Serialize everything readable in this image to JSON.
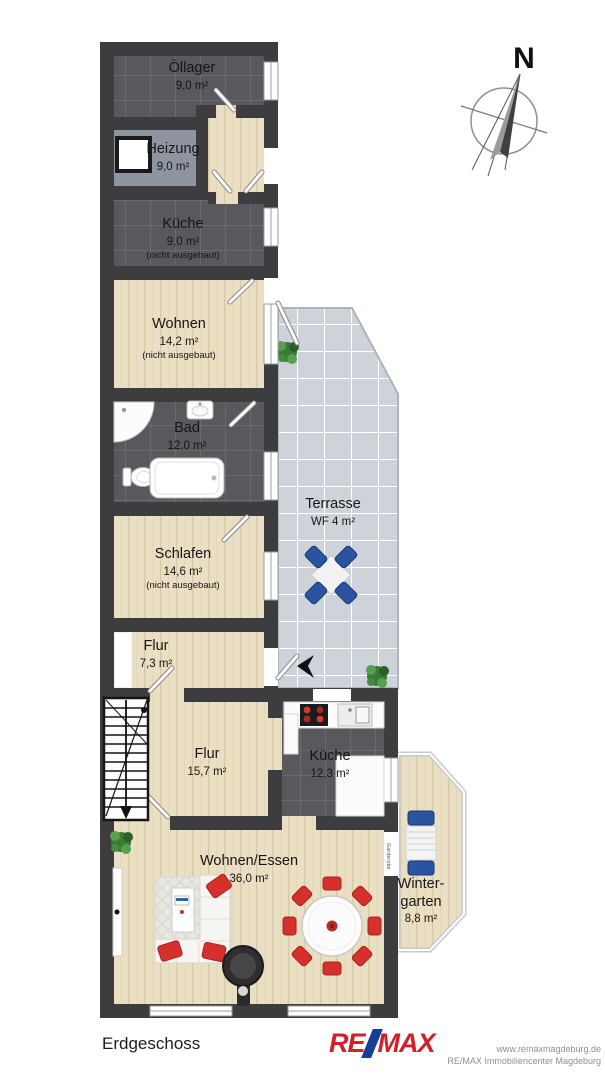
{
  "compass": {
    "north_label": "N"
  },
  "rooms": {
    "oellager": {
      "name": "Öllager",
      "area": "9,0 m²"
    },
    "heizung": {
      "name": "Heizung",
      "area": "9,0 m²"
    },
    "kueche_dg": {
      "name": "Küche",
      "area": "9,0 m²",
      "note": "(nicht ausgebaut)"
    },
    "wohnen": {
      "name": "Wohnen",
      "area": "14,2 m²",
      "note": "(nicht ausgebaut)"
    },
    "bad": {
      "name": "Bad",
      "area": "12,0 m²"
    },
    "schlafen": {
      "name": "Schlafen",
      "area": "14,6 m²",
      "note": "(nicht ausgebaut)"
    },
    "terrasse": {
      "name": "Terrasse",
      "area": "WF 4 m²"
    },
    "flur_klein": {
      "name": "Flur",
      "area": "7,3 m²"
    },
    "flur_gross": {
      "name": "Flur",
      "area": "15,7 m²"
    },
    "kueche_eg": {
      "name": "Küche",
      "area": "12,3 m²"
    },
    "wohnen_essen": {
      "name": "Wohnen/Essen",
      "area": "36,0 m²"
    },
    "wintergarten": {
      "name": "Winter-\ngarten",
      "area": "8,8 m²"
    },
    "garderobe": {
      "name": "Garderobe"
    }
  },
  "footer": {
    "floor_label": "Erdgeschoss",
    "logo": {
      "re": "RE",
      "max": "MAX"
    },
    "website": "www.remaxmagdeburg.de",
    "company": "RE/MAX Immobiliencenter Magdeburg"
  },
  "colors": {
    "wall": "#3d3d40",
    "tile_floor": "#59595d",
    "wood_floor": "#eadfc3",
    "terrace_floor": "#ced3da",
    "heizung_floor": "#8e95a1",
    "remax_red": "#d21f2a",
    "remax_blue": "#143f94",
    "chair_red": "#d5302c",
    "chair_blue": "#2a53a0"
  }
}
